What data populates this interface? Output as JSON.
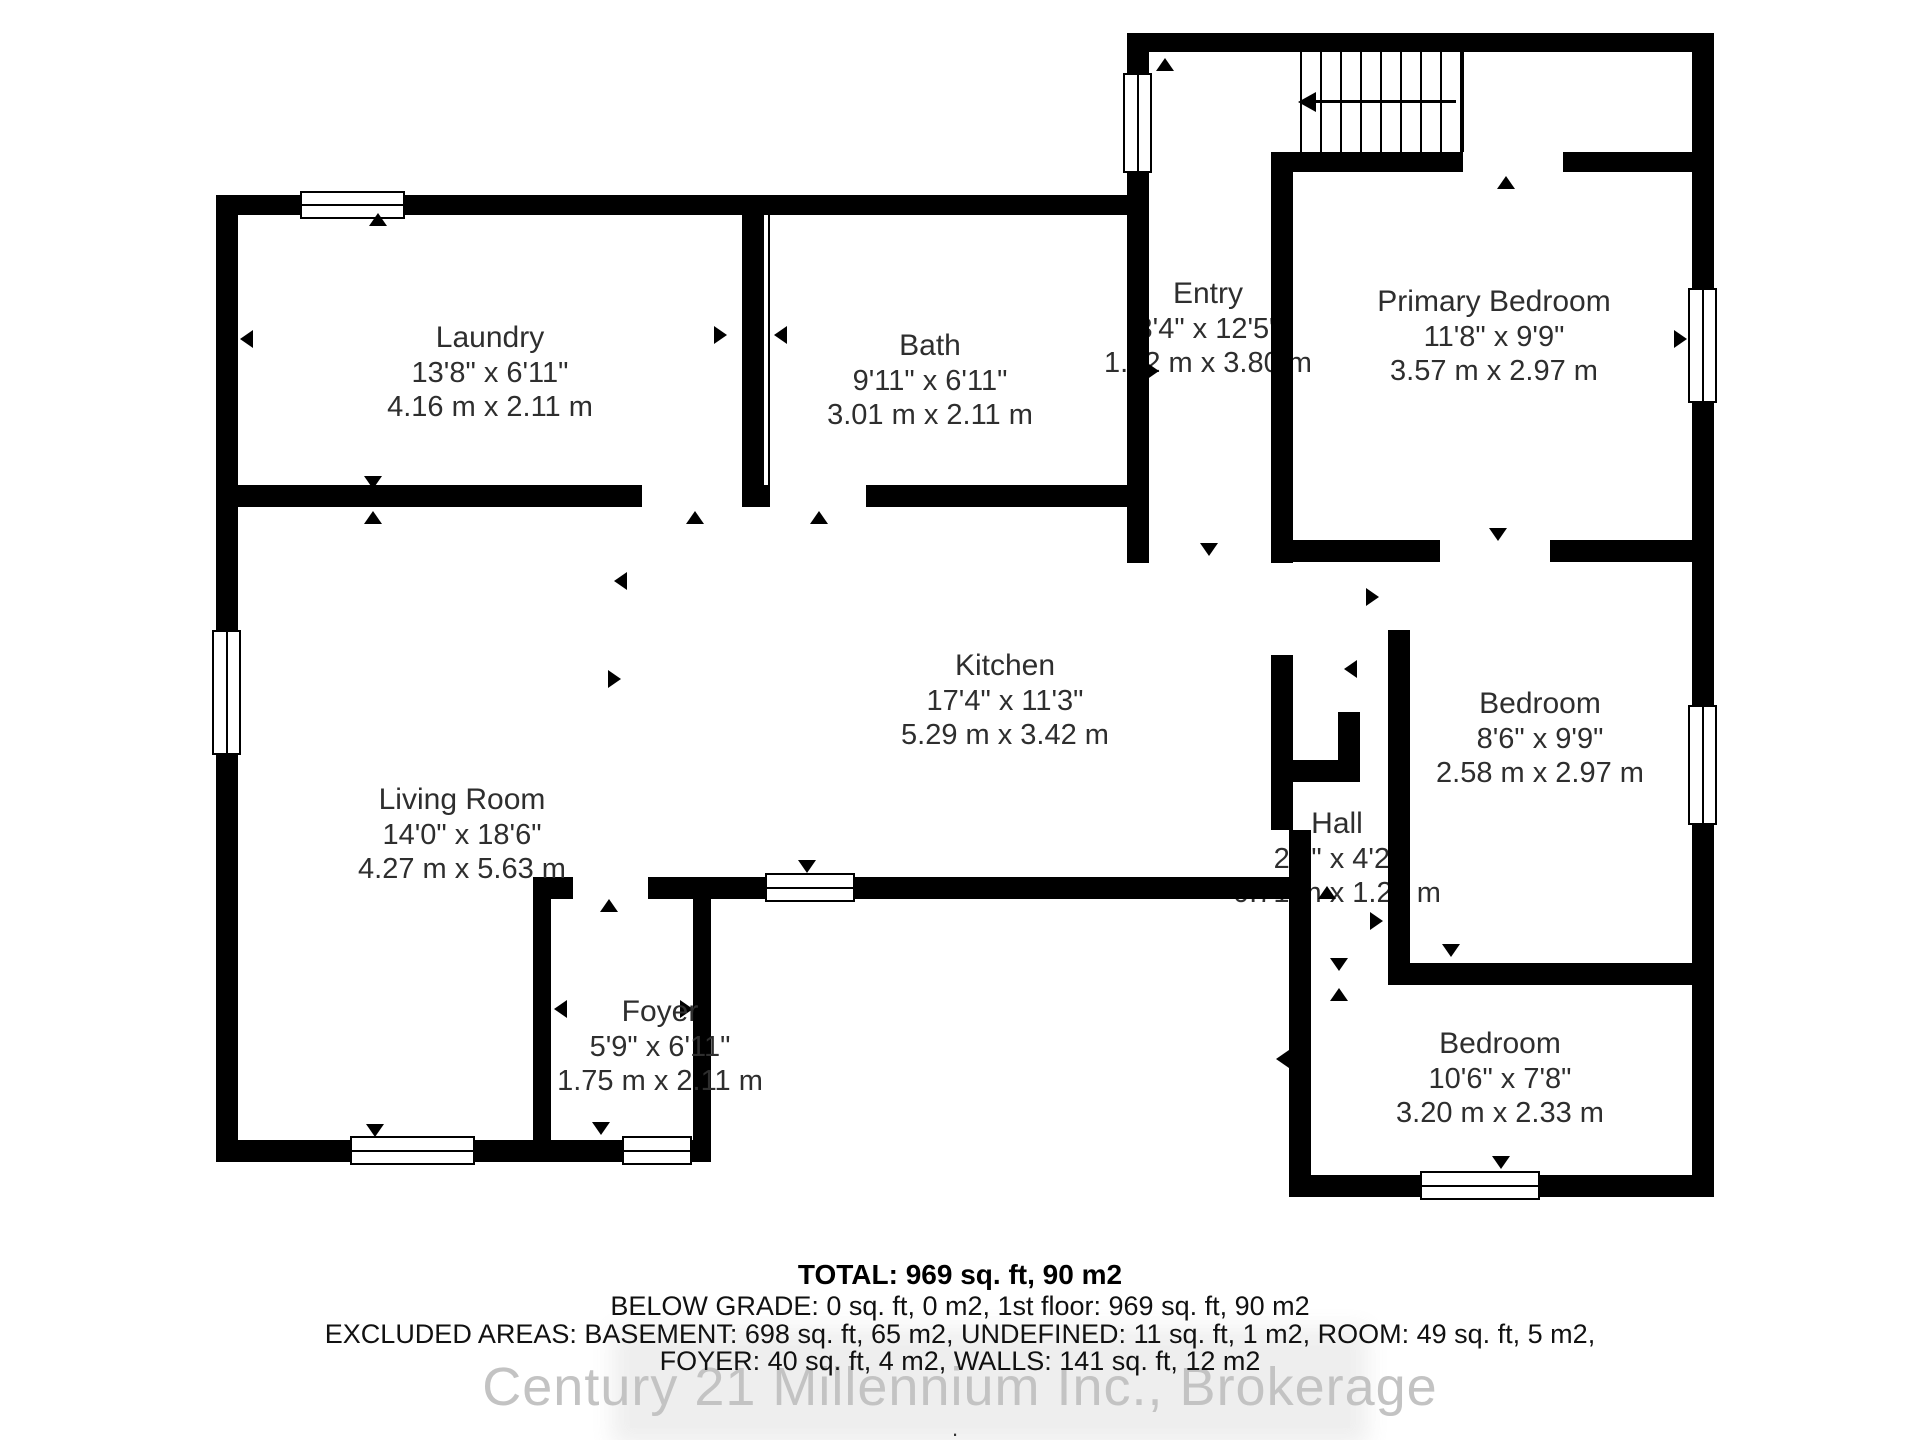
{
  "floorplan": {
    "rooms": {
      "laundry": {
        "name": "Laundry",
        "imperial": "13'8\" x 6'11\"",
        "metric": "4.16 m x 2.11 m"
      },
      "bath": {
        "name": "Bath",
        "imperial": "9'11\" x 6'11\"",
        "metric": "3.01 m x 2.11 m"
      },
      "entry": {
        "name": "Entry",
        "imperial": "3'4\" x 12'5\"",
        "metric": "1.02 m x 3.80 m"
      },
      "primary_bedroom": {
        "name": "Primary Bedroom",
        "imperial": "11'8\" x 9'9\"",
        "metric": "3.57 m x 2.97 m"
      },
      "kitchen": {
        "name": "Kitchen",
        "imperial": "17'4\" x 11'3\"",
        "metric": "5.29 m x 3.42 m"
      },
      "living_room": {
        "name": "Living Room",
        "imperial": "14'0\" x 18'6\"",
        "metric": "4.27 m x 5.63 m"
      },
      "hall": {
        "name": "Hall",
        "imperial": "2'4\" x 4'2\"",
        "metric": "0.71 m x 1.28 m"
      },
      "bedroom_right": {
        "name": "Bedroom",
        "imperial": "8'6\" x 9'9\"",
        "metric": "2.58 m x 2.97 m"
      },
      "bedroom_bottom": {
        "name": "Bedroom",
        "imperial": "10'6\" x 7'8\"",
        "metric": "3.20 m x 2.33 m"
      },
      "foyer": {
        "name": "Foyer",
        "imperial": "5'9\" x 6'11\"",
        "metric": "1.75 m x 2.11 m"
      }
    },
    "summary": {
      "total": "TOTAL: 969 sq. ft, 90 m2",
      "below_grade": "BELOW GRADE: 0 sq. ft, 0 m2, 1st floor: 969 sq. ft, 90 m2",
      "excluded_line1": "EXCLUDED AREAS: BASEMENT: 698 sq. ft, 65 m2, UNDEFINED: 11 sq. ft, 1 m2, ROOM: 49 sq. ft, 5 m2,",
      "excluded_line2": "FOYER: 40 sq. ft, 4 m2, WALLS: 141 sq. ft, 12 m2"
    },
    "watermark": "Century 21 Millennium Inc., Brokerage",
    "dot": ".",
    "colors": {
      "wall": "#000000",
      "label_text": "#2e2e2e",
      "watermark": "#c3c3c3"
    }
  }
}
